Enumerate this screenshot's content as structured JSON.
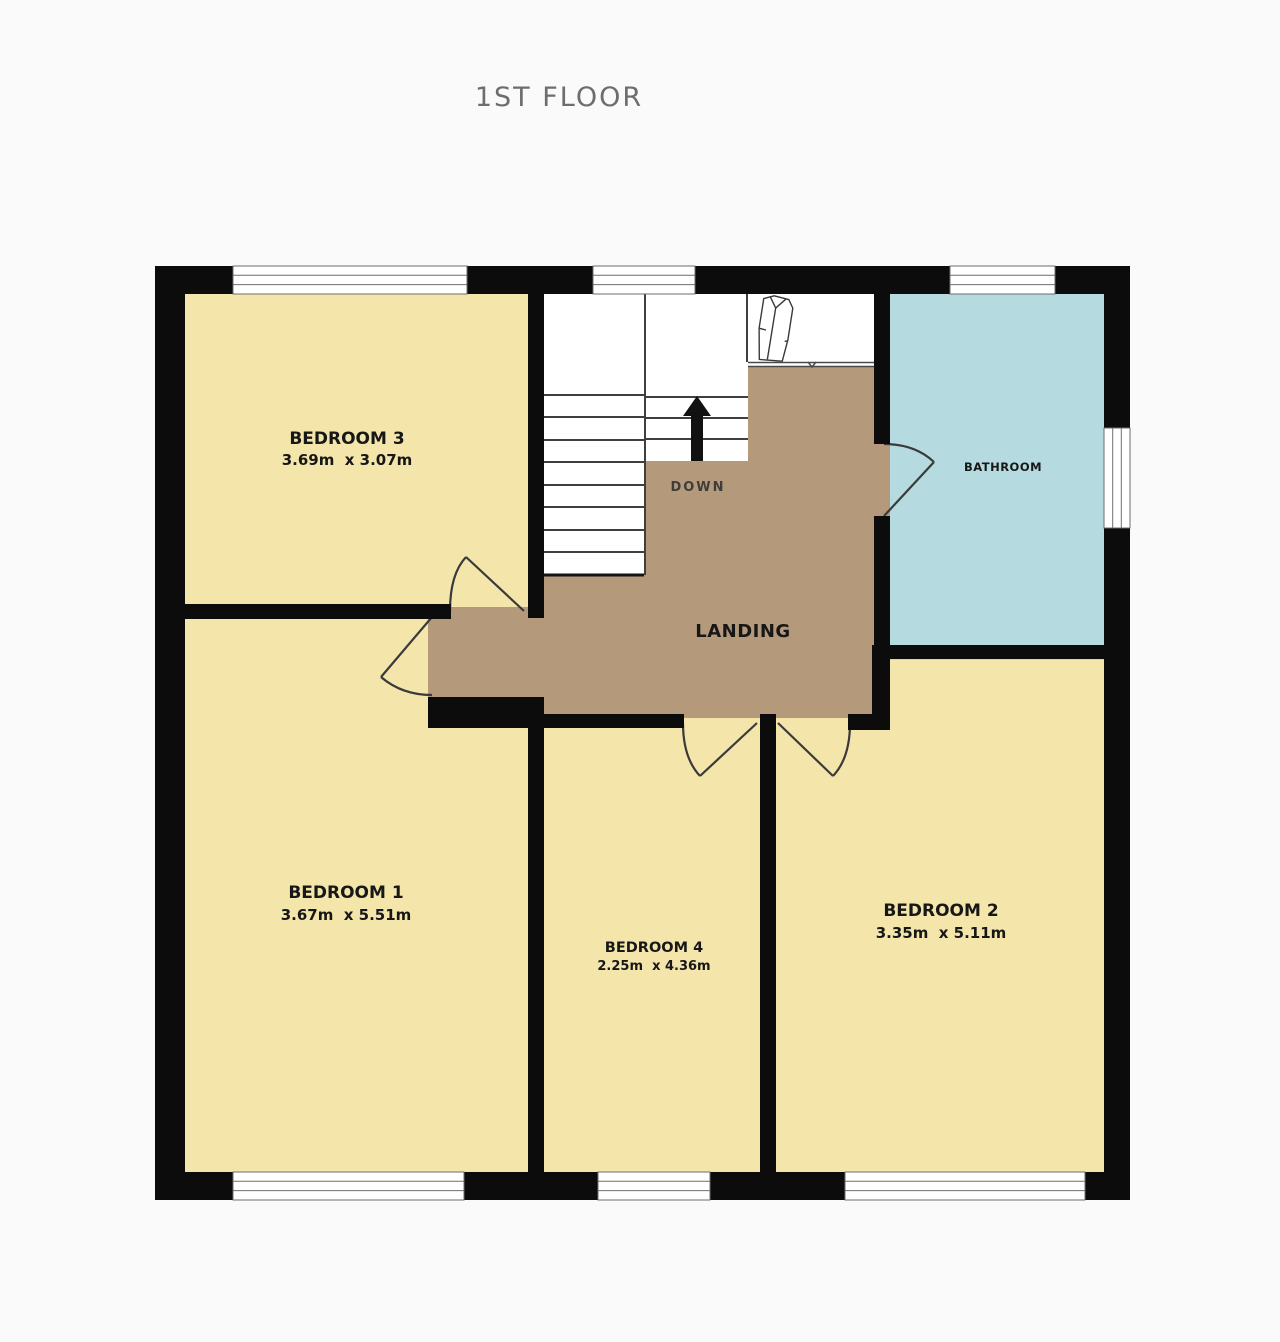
{
  "title": "1ST FLOOR",
  "rooms": {
    "bedroom3": {
      "name": "BEDROOM 3",
      "dims": "3.69m  x 3.07m"
    },
    "bedroom1": {
      "name": "BEDROOM 1",
      "dims": "3.67m  x 5.51m"
    },
    "bedroom4": {
      "name": "BEDROOM 4",
      "dims": "2.25m  x 4.36m"
    },
    "bedroom2": {
      "name": "BEDROOM 2",
      "dims": "3.35m  x 5.11m"
    },
    "bathroom": {
      "name": "BATHROOM"
    },
    "landing": {
      "name": "LANDING"
    }
  },
  "stairs": {
    "direction_label": "DOWN"
  },
  "colors": {
    "room_fill": "#f4e5ab",
    "landing_fill": "#b49a7b",
    "bathroom_fill": "#b5dbe0",
    "stairs_fill": "#ffffff",
    "wall": "#0c0c0c",
    "label_text": "#171717",
    "title_text": "#6d6d6d"
  }
}
